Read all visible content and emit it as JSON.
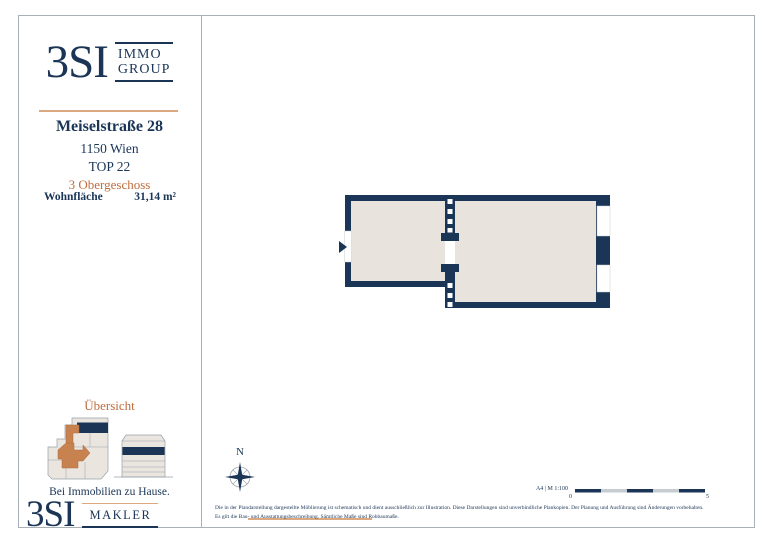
{
  "brand": {
    "name_large": "3SI",
    "immo": "IMMO",
    "group": "GROUP",
    "makler": "MAKLER",
    "tagline": "Bei Immobilien zu Hause."
  },
  "property": {
    "street": "Meiselstraße 28",
    "city": "1150 Wien",
    "unit": "TOP 22",
    "floor": "3 Obergeschoss",
    "area_label": "Wohnfläche",
    "area_value": "31,14 m²"
  },
  "overview": {
    "heading": "Übersicht"
  },
  "plan": {
    "compass_label": "N",
    "scale_label": "A4 | M 1:100",
    "scale_start": "0",
    "scale_end": "5"
  },
  "footer": {
    "disclaimer_line1": "Die in der Plandarstellung dargestellte Möblierung ist schematisch und dient ausschließlich zur Illustration. Diese Darstellungen sind unverbindliche Plankopien. Der Planung und Ausführung sind Änderungen vorbehalten.",
    "disclaimer_line2": "Es gilt die Bau- und Ausstattungsbeschreibung. Sämtliche Maße sind Rohbaumaße."
  },
  "colors": {
    "navy": "#1b3557",
    "orange": "#bf6d3d",
    "peach": "#dba87f",
    "room_fill": "#e8e4dd",
    "overview_unit_orange": "#c8824f"
  }
}
